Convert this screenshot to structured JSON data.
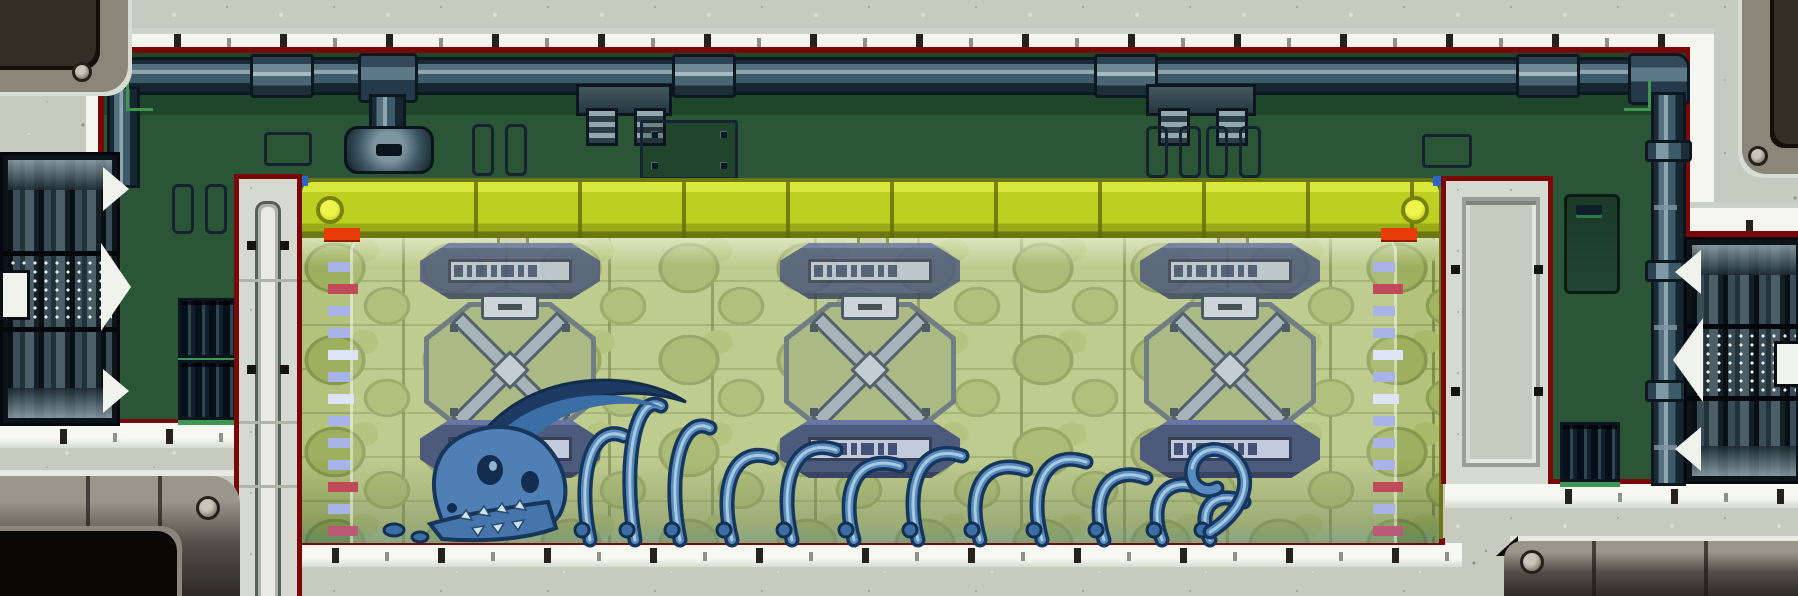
{
  "scene": {
    "name": "specimen-tank-lab-room",
    "description": "Pixel-art side-view laboratory corridor with a long sealed specimen tank containing the skeleton of a giant creature",
    "specimen": "giant creature skeleton: horned skull, curved ribs and tail bones resting on the tank floor"
  },
  "palette": {
    "wall_gray": "#c6cabf",
    "wall_white": "#eef0e8",
    "border_red": "#7a0808",
    "room_green": "#2a5637",
    "room_green_dark": "#1f462b",
    "pipe_dark": "#16262f",
    "pipe_light": "#8fa6ae",
    "tank_yellow": "#bdd022",
    "tank_frame_olive": "#6c7612",
    "glass_green": "#b4c37c",
    "bubble_green": "#9db05f",
    "plate_navy": "#2a3a66",
    "plate_strip": "#b6c2d8",
    "hatch_metal": "#97a5b0",
    "vent_green": "#3f9653",
    "accent_orange": "#ea3c08",
    "tick_blue": "#a8b4e8",
    "tick_red": "#c04a5a",
    "skeleton_blue": "#4f7fb5",
    "skeleton_dark": "#16365c",
    "skeleton_light": "#a9cade",
    "machine_dark": "#0c141a",
    "doorframe_metal": "#55514a"
  },
  "room": {
    "pipes": {
      "main_sleeves": 4,
      "right_pipe_collars": 3,
      "hanging_brackets": 2
    },
    "vents": {
      "left": 2,
      "right": 1
    },
    "slot_pairs": 4,
    "outline_panels": 2,
    "bolt_panel_bolts": 4,
    "access_door": {
      "wall": "right",
      "has_slot": true
    }
  },
  "tank": {
    "columns": [
      {
        "x": 118
      },
      {
        "x": 478
      },
      {
        "x": 838
      }
    ],
    "hatch_count": 3,
    "label_plates_top": 3,
    "label_plates_bottom": 3,
    "plate_glyphs": [
      9,
      5,
      11,
      6,
      13,
      6,
      9
    ],
    "gauge": {
      "top_marker_color": "#ea3c08",
      "ticks": [
        {
          "c": "#a8b4e8",
          "w": 22
        },
        {
          "c": "#c04a5a",
          "w": 30
        },
        {
          "c": "#a8b4e8",
          "w": 22
        },
        {
          "c": "#a8b4e8",
          "w": 22
        },
        {
          "c": "#dde4f6",
          "w": 30
        },
        {
          "c": "#a8b4e8",
          "w": 22
        },
        {
          "c": "#dde4f6",
          "w": 26
        },
        {
          "c": "#a8b4e8",
          "w": 22
        },
        {
          "c": "#a8b4e8",
          "w": 22
        },
        {
          "c": "#a8b4e8",
          "w": 22
        },
        {
          "c": "#c04a5a",
          "w": 30
        },
        {
          "c": "#a8b4e8",
          "w": 22
        },
        {
          "c": "#b85a78",
          "w": 30
        },
        {
          "c": "#a8b4e8",
          "w": 22
        }
      ]
    },
    "skeleton": {
      "ribs": [
        {
          "x": 258,
          "h": 118,
          "w": 34
        },
        {
          "x": 303,
          "h": 148,
          "w": 26
        },
        {
          "x": 348,
          "h": 126,
          "w": 30
        },
        {
          "x": 400,
          "h": 96,
          "w": 40
        },
        {
          "x": 460,
          "h": 104,
          "w": 44
        },
        {
          "x": 522,
          "h": 88,
          "w": 46
        },
        {
          "x": 586,
          "h": 98,
          "w": 44
        },
        {
          "x": 648,
          "h": 84,
          "w": 46
        },
        {
          "x": 710,
          "h": 92,
          "w": 44
        },
        {
          "x": 772,
          "h": 76,
          "w": 42
        },
        {
          "x": 830,
          "h": 66,
          "w": 38
        },
        {
          "x": 878,
          "h": 52,
          "w": 34
        }
      ],
      "tail_spiral": true
    },
    "wall_tick_spacing": 106
  }
}
